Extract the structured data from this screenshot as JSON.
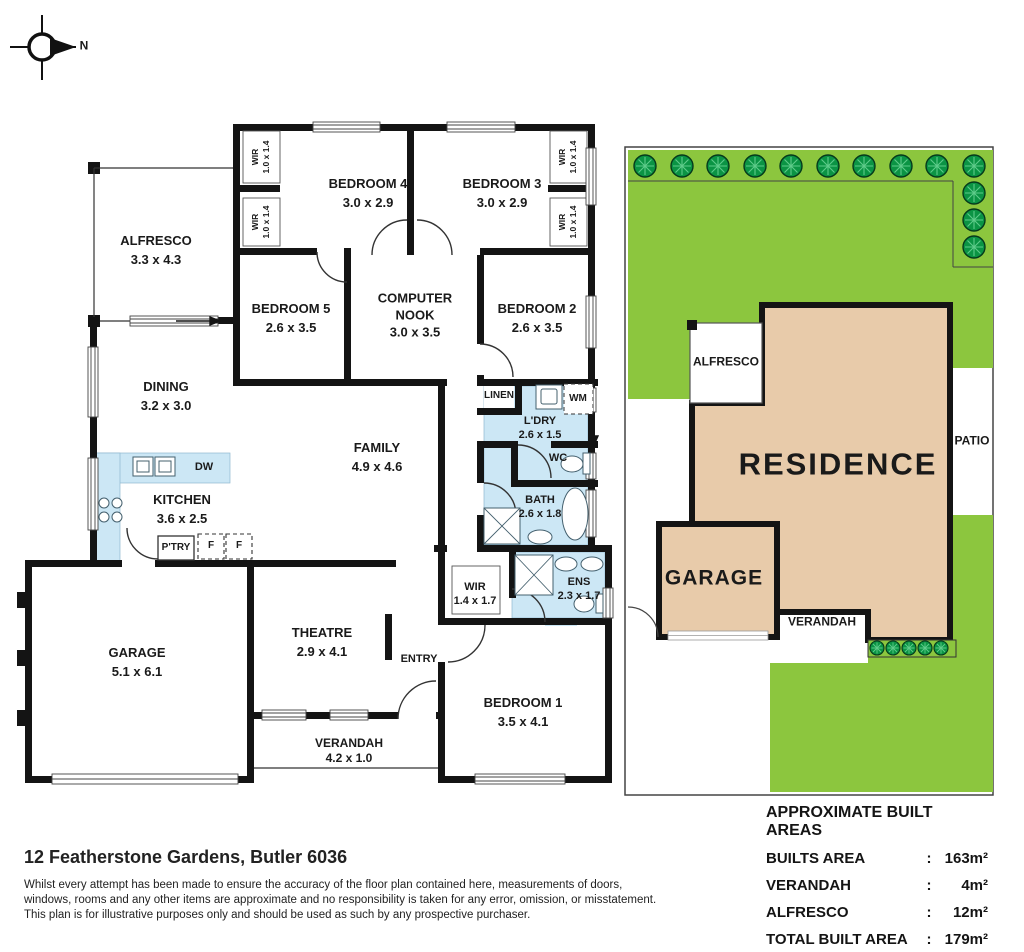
{
  "compass": {
    "north_label": "N"
  },
  "floor_plan": {
    "rooms": {
      "bedroom4": {
        "name": "BEDROOM 4",
        "dims": "3.0 x 2.9"
      },
      "bedroom3": {
        "name": "BEDROOM 3",
        "dims": "3.0 x 2.9"
      },
      "bedroom5": {
        "name": "BEDROOM 5",
        "dims": "2.6 x 3.5"
      },
      "computer_nook": {
        "name": "COMPUTER NOOK",
        "dims": "3.0 x 3.5"
      },
      "bedroom2": {
        "name": "BEDROOM 2",
        "dims": "2.6 x 3.5"
      },
      "alfresco": {
        "name": "ALFRESCO",
        "dims": "3.3 x 4.3"
      },
      "dining": {
        "name": "DINING",
        "dims": "3.2 x 3.0"
      },
      "family": {
        "name": "FAMILY",
        "dims": "4.9 x 4.6"
      },
      "kitchen": {
        "name": "KITCHEN",
        "dims": "3.6 x 2.5"
      },
      "laundry": {
        "name": "L'DRY",
        "dims": "2.6 x 1.5"
      },
      "bath": {
        "name": "BATH",
        "dims": "2.6 x 1.8"
      },
      "ensuite": {
        "name": "ENS",
        "dims": "2.3 x 1.7"
      },
      "wir_master": {
        "name": "WIR",
        "dims": "1.4 x 1.7"
      },
      "wir_small": {
        "name": "WIR",
        "dims": "1.0 x 1.4"
      },
      "garage": {
        "name": "GARAGE",
        "dims": "5.1 x 6.1"
      },
      "theatre": {
        "name": "THEATRE",
        "dims": "2.9 x 4.1"
      },
      "verandah": {
        "name": "VERANDAH",
        "dims": "4.2 x 1.0"
      },
      "bedroom1": {
        "name": "BEDROOM 1",
        "dims": "3.5 x 4.1"
      }
    },
    "fixtures": {
      "dw": "DW",
      "pantry": "P'TRY",
      "fridge": "F",
      "linen": "LINEN",
      "wm": "WM",
      "wc": "WC",
      "entry": "ENTRY"
    }
  },
  "site_plan": {
    "residence_label": "RESIDENCE",
    "garage_label": "GARAGE",
    "alfresco_label": "ALFRESCO",
    "patio_label": "PATIO",
    "verandah_label": "VERANDAH"
  },
  "areas_table": {
    "title": "APPROXIMATE BUILT AREAS",
    "rows": [
      {
        "label": "BUILTS AREA",
        "colon": ":",
        "value": "163m²"
      },
      {
        "label": "VERANDAH",
        "colon": ":",
        "value": "4m²"
      },
      {
        "label": "ALFRESCO",
        "colon": ":",
        "value": "12m²"
      },
      {
        "label": "TOTAL BUILT AREA",
        "colon": ":",
        "value": "179m²"
      }
    ]
  },
  "footer": {
    "address": "12 Featherstone Gardens, Butler 6036",
    "disclaimer_lines": [
      "Whilst every attempt has been made to ensure the accuracy of the floor plan contained here, measurements of doors,",
      "windows, rooms and any other items are approximate and no responsibility is taken for any error, omission, or misstatement.",
      "This plan is for illustrative purposes only and should be used as such by any prospective purchaser."
    ]
  },
  "colors": {
    "wet_area": "#cce7f5",
    "lawn": "#8cc63e",
    "tree_fill": "#0b9444",
    "residence_fill": "#e8cbaa",
    "wall": "#141414"
  }
}
